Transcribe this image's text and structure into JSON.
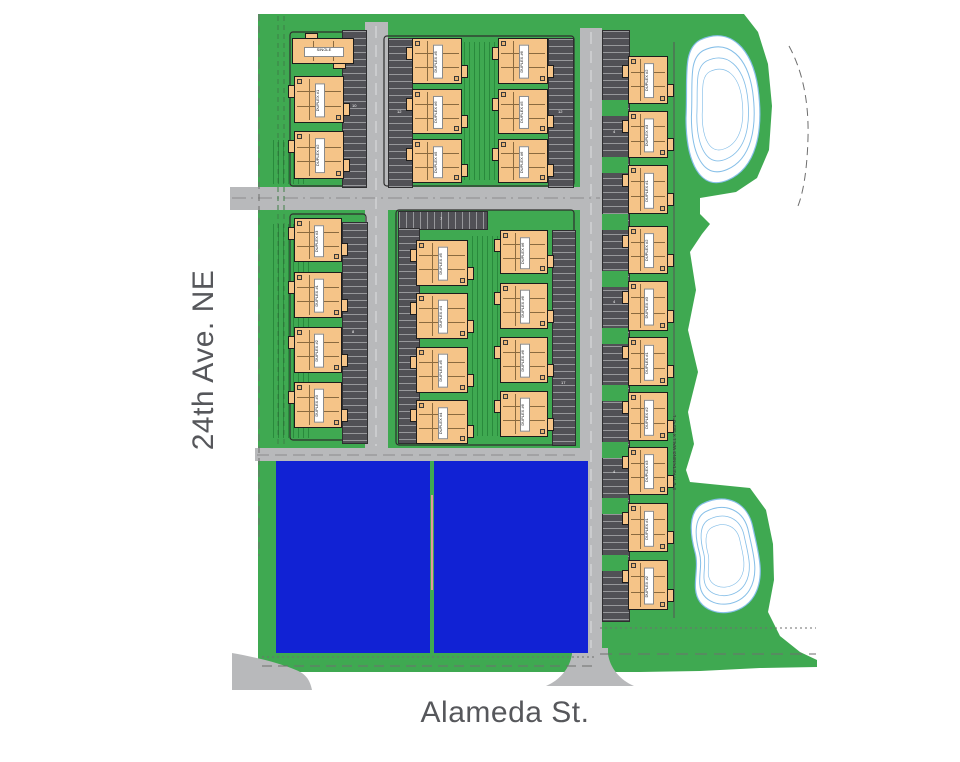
{
  "streets": {
    "left_label": "24th Ave. NE",
    "bottom_label": "Alameda St."
  },
  "notes": {
    "retaining_wall": "5'-0\" H RETAINING WALL X 383'-0\" L"
  },
  "colors": {
    "grass_green": "#3fa951",
    "road_gray": "#b8b9bb",
    "parking_gray": "#515156",
    "building_orange": "#f5c488",
    "building_outline": "#1c1c1c",
    "future_lot_blue": "#1122d4",
    "pond_contour_blue": "#86bfe8",
    "street_text_gray": "#56575b"
  },
  "buildings": [
    {
      "label": "SINGLE",
      "x": 292,
      "y": 38,
      "w": 62,
      "h": 26,
      "orient": "h"
    },
    {
      "label": "DUPLEX #1",
      "x": 294,
      "y": 76,
      "w": 50,
      "h": 47,
      "orient": "v"
    },
    {
      "label": "DUPLEX #2",
      "x": 294,
      "y": 131,
      "w": 50,
      "h": 48,
      "orient": "v"
    },
    {
      "label": "DUPLEX #5",
      "x": 412,
      "y": 38,
      "w": 50,
      "h": 46,
      "orient": "v"
    },
    {
      "label": "DUPLEX #6",
      "x": 412,
      "y": 89,
      "w": 50,
      "h": 45,
      "orient": "v"
    },
    {
      "label": "DUPLEX #5",
      "x": 412,
      "y": 139,
      "w": 50,
      "h": 44,
      "orient": "v"
    },
    {
      "label": "DUPLEX #6",
      "x": 498,
      "y": 38,
      "w": 50,
      "h": 46,
      "orient": "v"
    },
    {
      "label": "DUPLEX #5",
      "x": 498,
      "y": 89,
      "w": 50,
      "h": 45,
      "orient": "v"
    },
    {
      "label": "DUPLEX #6",
      "x": 498,
      "y": 139,
      "w": 50,
      "h": 44,
      "orient": "v"
    },
    {
      "label": "DUPLEX #2",
      "x": 628,
      "y": 56,
      "w": 40,
      "h": 48,
      "orient": "v"
    },
    {
      "label": "DUPLEX #3",
      "x": 628,
      "y": 111,
      "w": 40,
      "h": 47,
      "orient": "v"
    },
    {
      "label": "DUPLEX #1",
      "x": 628,
      "y": 165,
      "w": 40,
      "h": 49,
      "orient": "v"
    },
    {
      "label": "DUPLEX #2",
      "x": 628,
      "y": 226,
      "w": 40,
      "h": 48,
      "orient": "v"
    },
    {
      "label": "DUPLEX #3",
      "x": 628,
      "y": 281,
      "w": 40,
      "h": 50,
      "orient": "v"
    },
    {
      "label": "DUPLEX #1",
      "x": 628,
      "y": 337,
      "w": 40,
      "h": 49,
      "orient": "v"
    },
    {
      "label": "DUPLEX #2",
      "x": 628,
      "y": 392,
      "w": 40,
      "h": 49,
      "orient": "v"
    },
    {
      "label": "DUPLEX #3",
      "x": 628,
      "y": 447,
      "w": 40,
      "h": 48,
      "orient": "v"
    },
    {
      "label": "DUPLEX #1",
      "x": 628,
      "y": 503,
      "w": 40,
      "h": 49,
      "orient": "v"
    },
    {
      "label": "DUPLEX #2",
      "x": 628,
      "y": 560,
      "w": 40,
      "h": 50,
      "orient": "v"
    },
    {
      "label": "DUPLEX #3",
      "x": 294,
      "y": 218,
      "w": 48,
      "h": 44,
      "orient": "v"
    },
    {
      "label": "DUPLEX #1",
      "x": 294,
      "y": 272,
      "w": 48,
      "h": 46,
      "orient": "v"
    },
    {
      "label": "DUPLEX #2",
      "x": 294,
      "y": 327,
      "w": 48,
      "h": 46,
      "orient": "v"
    },
    {
      "label": "DUPLEX #3",
      "x": 294,
      "y": 382,
      "w": 48,
      "h": 46,
      "orient": "v"
    },
    {
      "label": "DUPLEX #5",
      "x": 416,
      "y": 240,
      "w": 52,
      "h": 46,
      "orient": "v"
    },
    {
      "label": "DUPLEX #4",
      "x": 416,
      "y": 293,
      "w": 52,
      "h": 46,
      "orient": "v"
    },
    {
      "label": "DUPLEX #5",
      "x": 416,
      "y": 347,
      "w": 52,
      "h": 46,
      "orient": "v"
    },
    {
      "label": "DUPLEX #4",
      "x": 416,
      "y": 400,
      "w": 52,
      "h": 44,
      "orient": "v"
    },
    {
      "label": "DUPLEX #6",
      "x": 500,
      "y": 230,
      "w": 48,
      "h": 44,
      "orient": "v"
    },
    {
      "label": "DUPLEX #6",
      "x": 500,
      "y": 283,
      "w": 48,
      "h": 46,
      "orient": "v"
    },
    {
      "label": "DUPLEX #6",
      "x": 500,
      "y": 337,
      "w": 48,
      "h": 46,
      "orient": "v"
    },
    {
      "label": "DUPLEX #6",
      "x": 500,
      "y": 391,
      "w": 48,
      "h": 46,
      "orient": "v"
    }
  ],
  "parking_strips": [
    {
      "x": 342,
      "y": 30,
      "w": 23,
      "h": 156,
      "dir": "v"
    },
    {
      "x": 388,
      "y": 38,
      "w": 23,
      "h": 148,
      "dir": "v"
    },
    {
      "x": 548,
      "y": 38,
      "w": 24,
      "h": 148,
      "dir": "v"
    },
    {
      "x": 342,
      "y": 222,
      "w": 24,
      "h": 220,
      "dir": "v"
    },
    {
      "x": 398,
      "y": 211,
      "w": 88,
      "h": 17,
      "dir": "h"
    },
    {
      "x": 398,
      "y": 228,
      "w": 20,
      "h": 214,
      "dir": "v"
    },
    {
      "x": 552,
      "y": 230,
      "w": 22,
      "h": 214,
      "dir": "v"
    },
    {
      "x": 602,
      "y": 30,
      "w": 26,
      "h": 590,
      "dir": "v"
    }
  ],
  "parking_breaks_right_column_y": [
    100,
    157,
    214,
    271,
    328,
    385,
    442,
    498,
    555
  ],
  "parking_stall_numbers": [
    {
      "t": "10",
      "x": 352,
      "y": 104
    },
    {
      "t": "12",
      "x": 397,
      "y": 110
    },
    {
      "t": "12",
      "x": 558,
      "y": 110
    },
    {
      "t": "8",
      "x": 352,
      "y": 330
    },
    {
      "t": "7",
      "x": 440,
      "y": 217
    },
    {
      "t": "17",
      "x": 561,
      "y": 381
    },
    {
      "t": "4",
      "x": 613,
      "y": 130
    },
    {
      "t": "4",
      "x": 613,
      "y": 300
    },
    {
      "t": "4",
      "x": 613,
      "y": 470
    }
  ],
  "future_lots": [
    {
      "x": 276,
      "y": 461,
      "w": 154,
      "h": 192
    },
    {
      "x": 434,
      "y": 461,
      "w": 154,
      "h": 192
    }
  ],
  "ponds": {
    "count": 2,
    "style": "white retention ponds with concentric blue contours"
  }
}
